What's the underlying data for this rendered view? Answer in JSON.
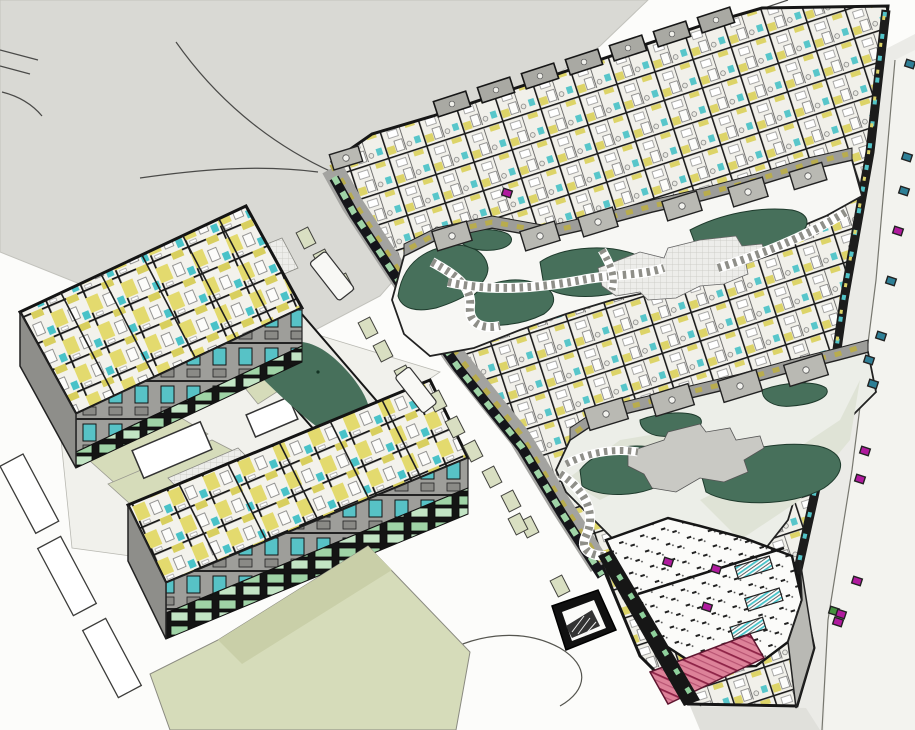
{
  "app": {
    "title": "3D site model — axonometric cutaway view"
  },
  "scene": {
    "description": "Axonometric cutaway 3D model of a housing development: two residential complexes with exposed apartment floor plans (yellow walls, teal stairs), perimeter block with two landscaped courtyards, dark green lawns, stepping-stone paths, tiled plazas, ground-floor green storefronts, an open office/school floor with desks, pink tiered auditorium seating, a parking ramp, streets with crosswalk pavers and small street markers.",
    "colors": {
      "ground_gray": "#d9d9d4",
      "paper_white": "#fcfcfa",
      "road_light": "#ebebe7",
      "road_lighter": "#f3f3ef",
      "lawn_pale": "#d6dcba",
      "lawn_dark": "#47705b",
      "wall_dark": "#1b1b1b",
      "floor_light": "#f1f0ea",
      "room_yellow": "#ddd468",
      "accent_teal": "#52c4c9",
      "storefront_green": "#9fd3a6",
      "facade_gray": "#9e9e9a",
      "window_olive": "#b8ac4e",
      "plaza_tile": "#ededea",
      "seat_pink": "#dd8299",
      "marker_magenta": "#b01a9e",
      "marker_blue": "#2e7f96",
      "marker_green": "#45913f",
      "crosswalk_pale": "#d9dfc2"
    },
    "street_markers": [
      {
        "x": 910,
        "y": 64,
        "c": "marker_blue"
      },
      {
        "x": 907,
        "y": 157,
        "c": "marker_blue"
      },
      {
        "x": 904,
        "y": 191,
        "c": "marker_blue"
      },
      {
        "x": 898,
        "y": 231,
        "c": "marker_magenta"
      },
      {
        "x": 891,
        "y": 281,
        "c": "marker_blue"
      },
      {
        "x": 881,
        "y": 336,
        "c": "marker_blue"
      },
      {
        "x": 869,
        "y": 360,
        "c": "marker_blue"
      },
      {
        "x": 873,
        "y": 384,
        "c": "marker_blue"
      },
      {
        "x": 865,
        "y": 451,
        "c": "marker_magenta"
      },
      {
        "x": 860,
        "y": 479,
        "c": "marker_magenta"
      },
      {
        "x": 857,
        "y": 581,
        "c": "marker_magenta"
      },
      {
        "x": 834,
        "y": 611,
        "c": "marker_green"
      },
      {
        "x": 841,
        "y": 614,
        "c": "marker_magenta"
      },
      {
        "x": 838,
        "y": 622,
        "c": "marker_magenta"
      }
    ],
    "interior_markers": [
      {
        "x": 668,
        "y": 562,
        "c": "marker_magenta"
      },
      {
        "x": 716,
        "y": 569,
        "c": "marker_magenta"
      },
      {
        "x": 707,
        "y": 607,
        "c": "marker_magenta"
      },
      {
        "x": 507,
        "y": 193,
        "c": "marker_magenta"
      }
    ],
    "crosswalk_squares": [
      {
        "x": 306,
        "y": 238
      },
      {
        "x": 323,
        "y": 260
      },
      {
        "x": 344,
        "y": 284
      },
      {
        "x": 368,
        "y": 328
      },
      {
        "x": 383,
        "y": 351
      },
      {
        "x": 404,
        "y": 376
      },
      {
        "x": 437,
        "y": 401
      },
      {
        "x": 455,
        "y": 427
      },
      {
        "x": 473,
        "y": 451
      },
      {
        "x": 492,
        "y": 477
      },
      {
        "x": 511,
        "y": 501
      },
      {
        "x": 529,
        "y": 527
      },
      {
        "x": 518,
        "y": 524
      },
      {
        "x": 560,
        "y": 586
      }
    ],
    "terraces_upper_courtyard": [
      {
        "x": 452,
        "y": 236,
        "w": 36,
        "h": 20
      },
      {
        "x": 540,
        "y": 236,
        "w": 36,
        "h": 20
      },
      {
        "x": 598,
        "y": 222,
        "w": 36,
        "h": 20
      },
      {
        "x": 682,
        "y": 206,
        "w": 36,
        "h": 20
      },
      {
        "x": 748,
        "y": 192,
        "w": 36,
        "h": 20
      },
      {
        "x": 808,
        "y": 176,
        "w": 34,
        "h": 18
      },
      {
        "x": 346,
        "y": 158,
        "w": 30,
        "h": 16
      }
    ],
    "terraces_lower_courtyard": [
      {
        "x": 606,
        "y": 414,
        "w": 40,
        "h": 22
      },
      {
        "x": 672,
        "y": 400,
        "w": 40,
        "h": 22
      },
      {
        "x": 740,
        "y": 386,
        "w": 40,
        "h": 22
      },
      {
        "x": 806,
        "y": 370,
        "w": 40,
        "h": 22
      }
    ],
    "roof_balconies": [
      {
        "x": 452,
        "y": 104
      },
      {
        "x": 496,
        "y": 90
      },
      {
        "x": 540,
        "y": 76
      },
      {
        "x": 584,
        "y": 62
      },
      {
        "x": 628,
        "y": 48
      },
      {
        "x": 672,
        "y": 34
      },
      {
        "x": 716,
        "y": 20
      }
    ]
  }
}
